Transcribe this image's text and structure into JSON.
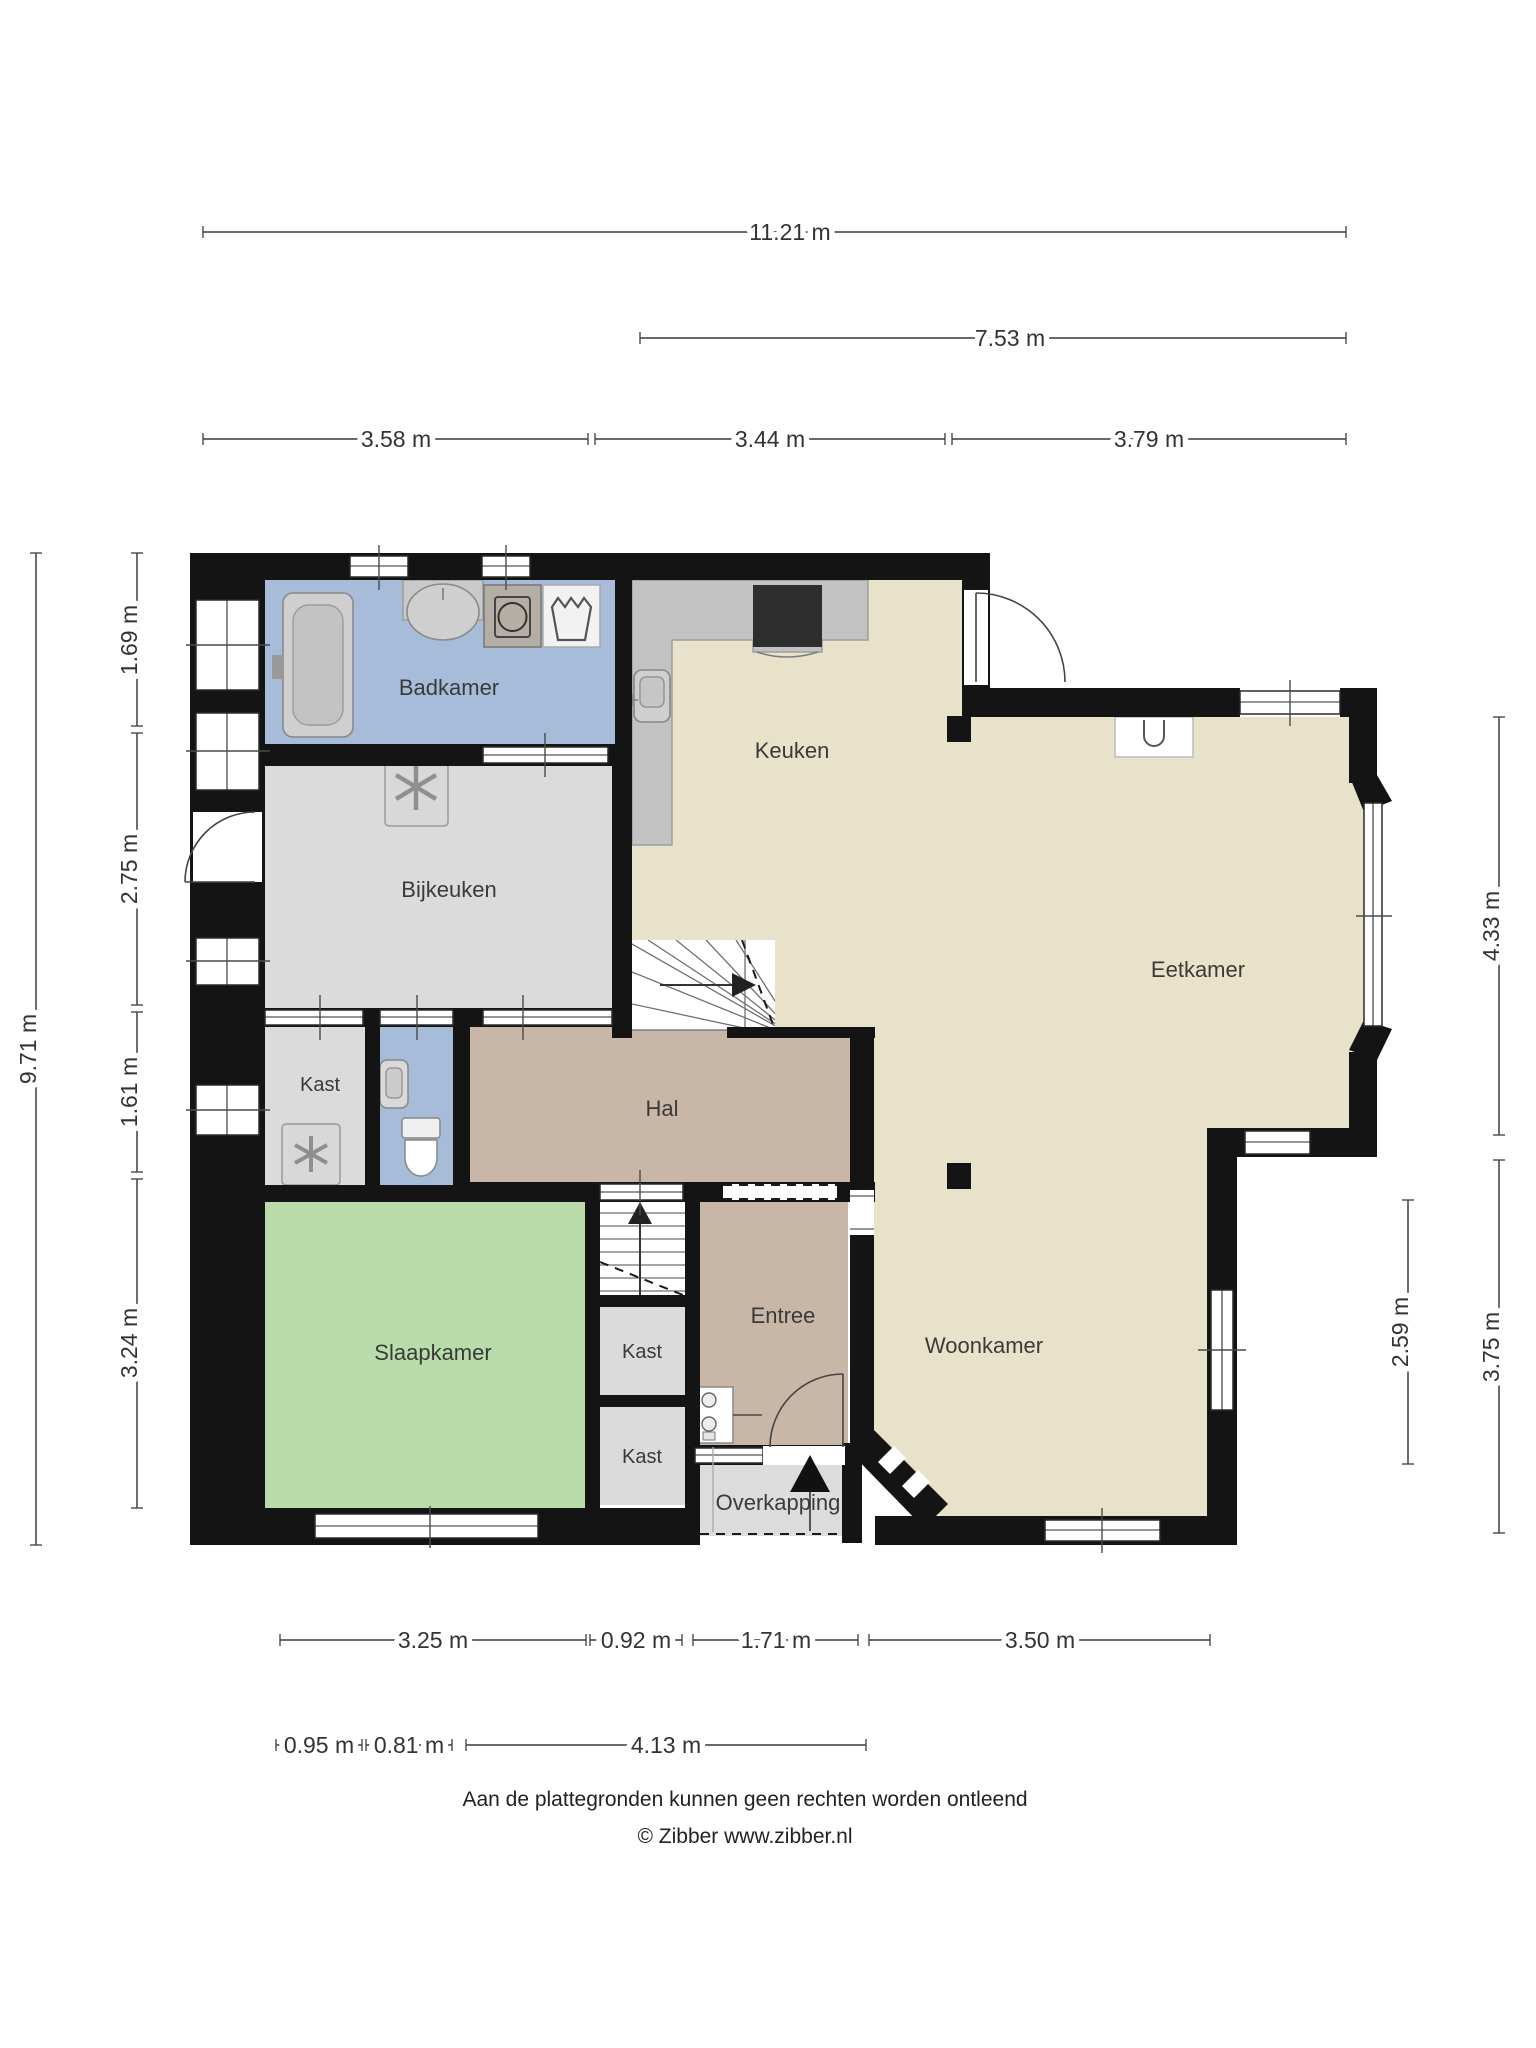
{
  "plan_type": "floorplan-ground-floor",
  "rooms": {
    "badkamer": {
      "label": "Badkamer"
    },
    "keuken": {
      "label": "Keuken"
    },
    "bijkeuken": {
      "label": "Bijkeuken"
    },
    "eetkamer": {
      "label": "Eetkamer"
    },
    "kast_bij_toilet": {
      "label": "Kast"
    },
    "hal": {
      "label": "Hal"
    },
    "slaapkamer": {
      "label": "Slaapkamer"
    },
    "kast_boven": {
      "label": "Kast"
    },
    "kast_onder": {
      "label": "Kast"
    },
    "entree": {
      "label": "Entree"
    },
    "woonkamer": {
      "label": "Woonkamer"
    },
    "overkapping": {
      "label": "Overkapping"
    }
  },
  "dimensions": {
    "top": [
      {
        "label": "11.21 m"
      },
      {
        "label": "7.53 m"
      },
      {
        "label": "3.58 m"
      },
      {
        "label": "3.44 m"
      },
      {
        "label": "3.79 m"
      }
    ],
    "left": [
      {
        "label": "9.71 m"
      },
      {
        "label": "1.69 m"
      },
      {
        "label": "2.75 m"
      },
      {
        "label": "1.61 m"
      },
      {
        "label": "3.24 m"
      }
    ],
    "right": [
      {
        "label": "4.33 m"
      },
      {
        "label": "3.75 m"
      },
      {
        "label": "2.59 m"
      }
    ],
    "bottom": [
      {
        "label": "3.25 m"
      },
      {
        "label": "0.92 m"
      },
      {
        "label": "1.71 m"
      },
      {
        "label": "3.50 m"
      },
      {
        "label": "0.95 m"
      },
      {
        "label": "0.81 m"
      },
      {
        "label": "4.13 m"
      }
    ]
  },
  "footer": {
    "line1": "Aan de plattegronden kunnen geen rechten worden ontleend",
    "line2": "© Zibber www.zibber.nl"
  },
  "colors": {
    "wall": "#141414",
    "badkamer": "#a7bcd8",
    "toilet": "#a7bcd8",
    "bijkeuken": "#dbdbdb",
    "kast": "#dbdbdb",
    "overkapping": "#dcdcdc",
    "hal": "#c8b7a6",
    "entree": "#c8b7a6",
    "leefruimte": "#e9e2cb",
    "slaapkamer": "#b9dcaa",
    "counter": "#c2c2c2",
    "cooktop": "#2e2e2e",
    "dimension_text": "#333333"
  },
  "icons": {
    "fixtures": [
      "bathtub-icon",
      "washbasin-icon",
      "washing-machine-icon",
      "laundry-basket-icon",
      "freezer-snowflake-icon",
      "freezer-snowflake-icon",
      "kitchen-sink-icon",
      "cooktop-icon",
      "toilet-icon",
      "hand-basin-icon",
      "stairs-winder-icon",
      "stairs-straight-icon",
      "entrance-arrow-icon",
      "door-swing-icon",
      "fireplace-icon",
      "meter-cabinet-icon"
    ]
  }
}
